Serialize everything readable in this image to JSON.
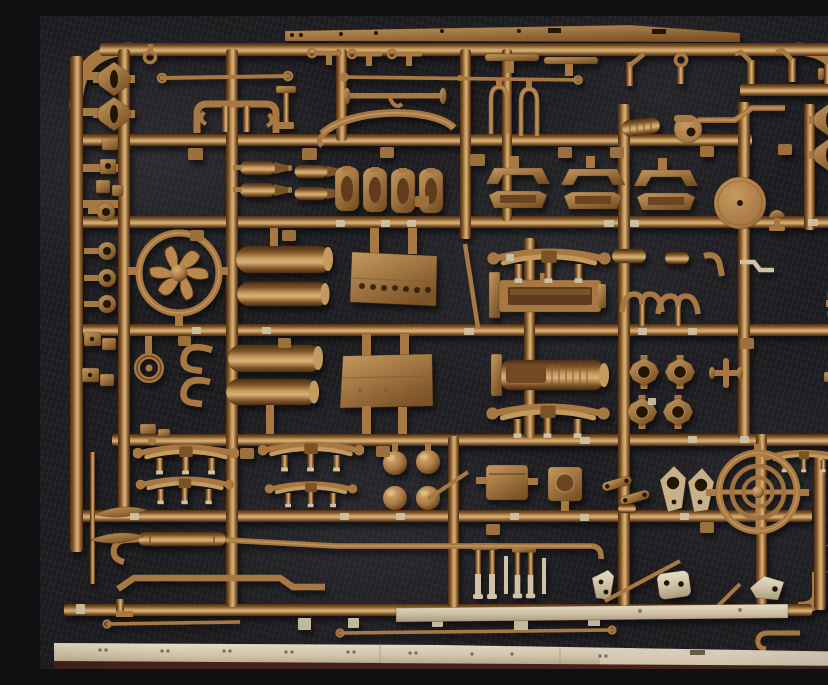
{
  "scene": {
    "type": "photograph",
    "aria_label": "Photograph of a tan injection-moulded plastic model kit sprue filled with small vehicle parts, lying on dark grey fabric",
    "subject": "model-kit parts sprue (sand / tan coloured styrene)",
    "background": "dark charcoal fabric with mottled lighter patches"
  },
  "palette": {
    "bg": "#1d1d21",
    "bgLight": "#3a3a42",
    "pEdge": "#4f3014",
    "pDark": "#7c5226",
    "pMid": "#a87843",
    "pLight": "#c59a5f",
    "pHi": "#d9b177",
    "lightPart": "#cfc2a8",
    "lightDeep": "#a99a7d",
    "darkPanel": "#6b431d",
    "bottomEdge": "#44201a"
  },
  "parts_inventory": [
    "rectangular sprue frame with grid of round runners",
    "six-blade cooling fan inside circular shroud",
    "four cylindrical fuel tanks with domed ends",
    "two rectangular louvred hull panels",
    "three trapezoid hatch frames",
    "four small bogie frames",
    "four tapered shell bodies",
    "leaf springs with shackle posts (seven)",
    "steering wheel with concentric rims and cross spokes",
    "large plain road-wheel disc",
    "four diamond hub plates with centre holes",
    "four ball heads",
    "two gearbox blocks",
    "two long I-beam engine/radiator parts",
    "clevis forks and two-tone front forks",
    "exhaust pipe with muffler body",
    "thin tie-rods with eyelet ends",
    "diamond lifting-eye plates (four on frame edges)",
    "light flat fender strip with rivets along bottom",
    "dark moulded maker panel at top right",
    "figure-eight bracket, tow hooks, pulley, wishbone and gusset plates"
  ]
}
